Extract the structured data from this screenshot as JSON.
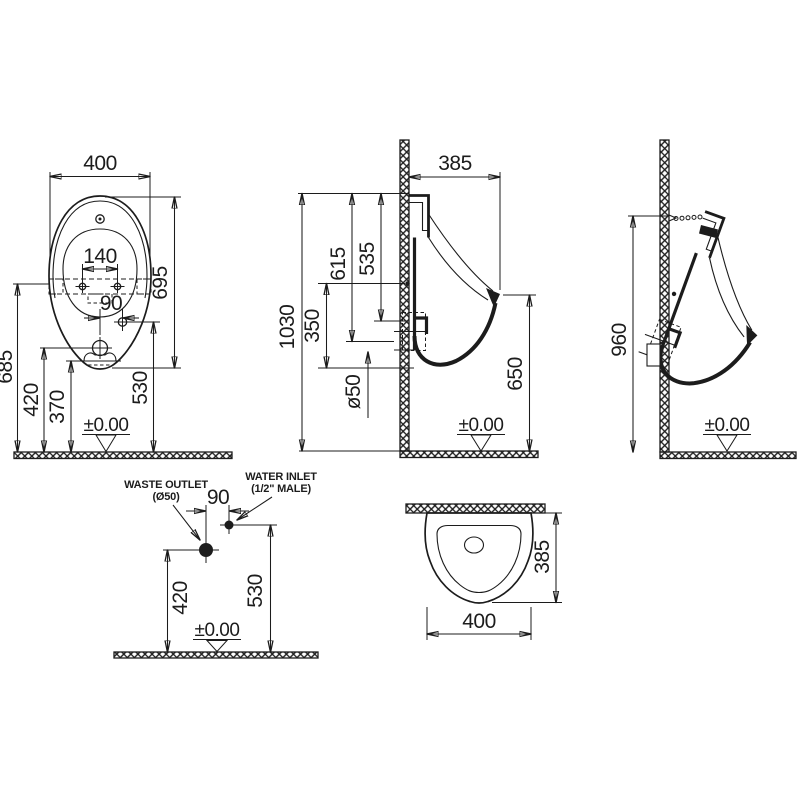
{
  "front": {
    "width": "400",
    "hole_spacing": "140",
    "inlet_offset": "90",
    "height": "695",
    "mount_height": "685",
    "inlet_height": "530",
    "outlet_height": "420",
    "rim_height": "370",
    "datum": "±0.00"
  },
  "side": {
    "depth": "385",
    "total_height": "1030",
    "top_to_outlet": "615",
    "top_to_inlet": "535",
    "mount_to_bottom": "350",
    "outlet_diameter": "ø50",
    "lip_height": "650",
    "datum": "±0.00"
  },
  "install": {
    "hanger_height": "960",
    "datum": "±0.00"
  },
  "detail": {
    "waste_outlet_label": "WASTE OUTLET",
    "waste_outlet_size": "(Ø50)",
    "water_inlet_label": "WATER INLET",
    "water_inlet_size": "(1/2\" MALE)",
    "offset": "90",
    "outlet_height": "420",
    "inlet_height": "530",
    "datum": "±0.00"
  },
  "top": {
    "depth": "385",
    "width": "400"
  }
}
